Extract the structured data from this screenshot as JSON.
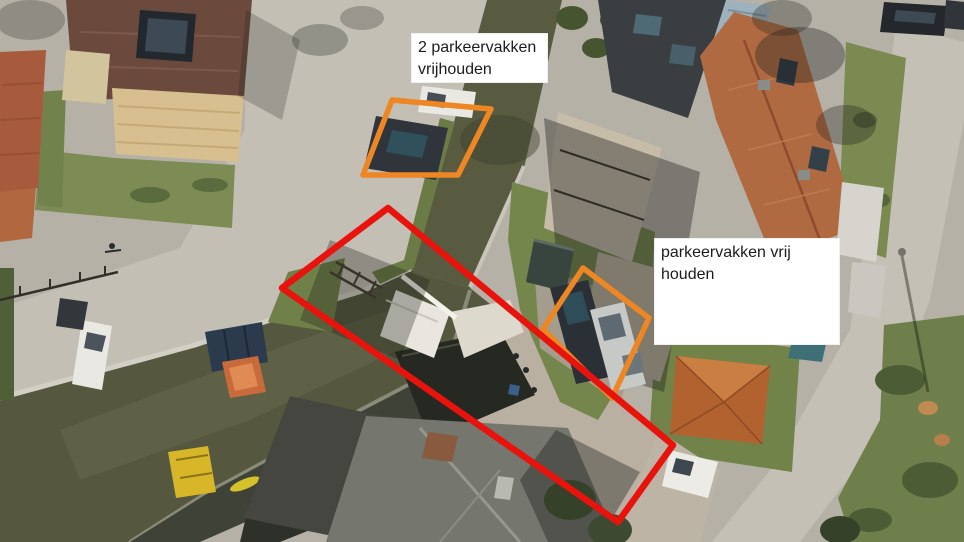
{
  "scene": {
    "type": "annotated aerial photograph",
    "description": "Aerial photo of a canal with a white drawbridge, surrounding streets, tiled-roof houses, parked cars and boats. Two parking areas are outlined in orange and a long clearance corridor across the bridge is outlined in red."
  },
  "annotations": {
    "label_top": {
      "line1": "2 parkeervakken",
      "line2": "vrijhouden"
    },
    "label_right": {
      "line1": "parkeervakken vrij",
      "line2": "houden"
    },
    "shapes": [
      {
        "name": "orange-parking-zone-top",
        "color": "#ee8624",
        "stroke_width": 5.5,
        "points": "392,100 491,109 458,175 363,175"
      },
      {
        "name": "orange-parking-zone-right",
        "color": "#ee8624",
        "stroke_width": 5.5,
        "points": "583,268 649,318 612,398 543,329"
      },
      {
        "name": "red-clearance-corridor",
        "color": "#e8130c",
        "stroke_width": 6.5,
        "points": "388,208 673,445 618,522 282,288"
      }
    ],
    "colors": {
      "highlight_orange": "#ee8624",
      "highlight_red": "#e8130c",
      "label_background": "#ffffff",
      "label_text": "#1c1c1c"
    }
  }
}
